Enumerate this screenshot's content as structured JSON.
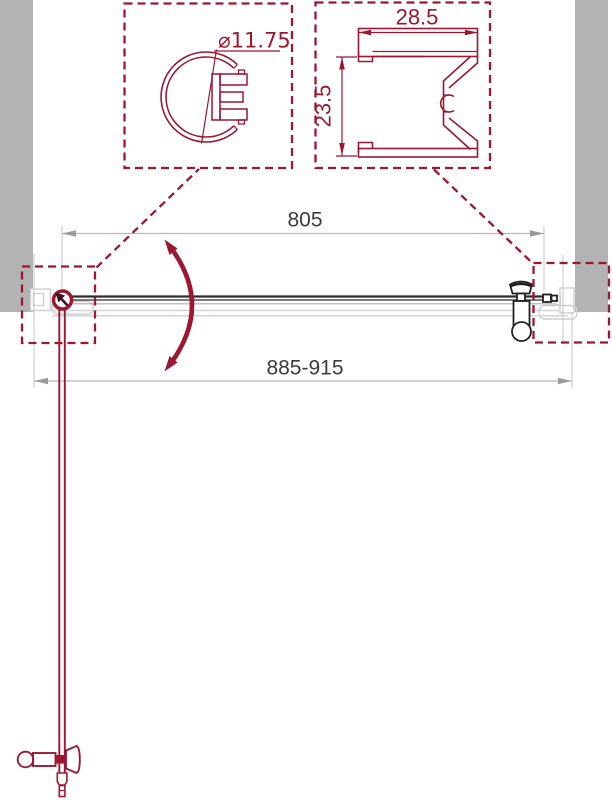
{
  "texts": {
    "detail_knob_diameter": "⌀11.75",
    "detail_wall_profile_width": "28.5",
    "detail_wall_profile_height": "23.5",
    "dim_door_width": "805",
    "dim_opening_range": "885-915"
  },
  "colors": {
    "accent_red": "#9B1732",
    "wall_gray": "#B3B3B3",
    "dim_text_gray": "#3C3C3C",
    "dim_line_gray": "#B8B8B8",
    "arrow_gray": "#9A9A9A",
    "glass_dark": "#2E2E2E",
    "profile_light_gray": "#CFCFCF"
  },
  "icons": {
    "door_swing_arc": "curved-double-arrow",
    "hinge_pivot": "pivot-rotation-marker"
  }
}
